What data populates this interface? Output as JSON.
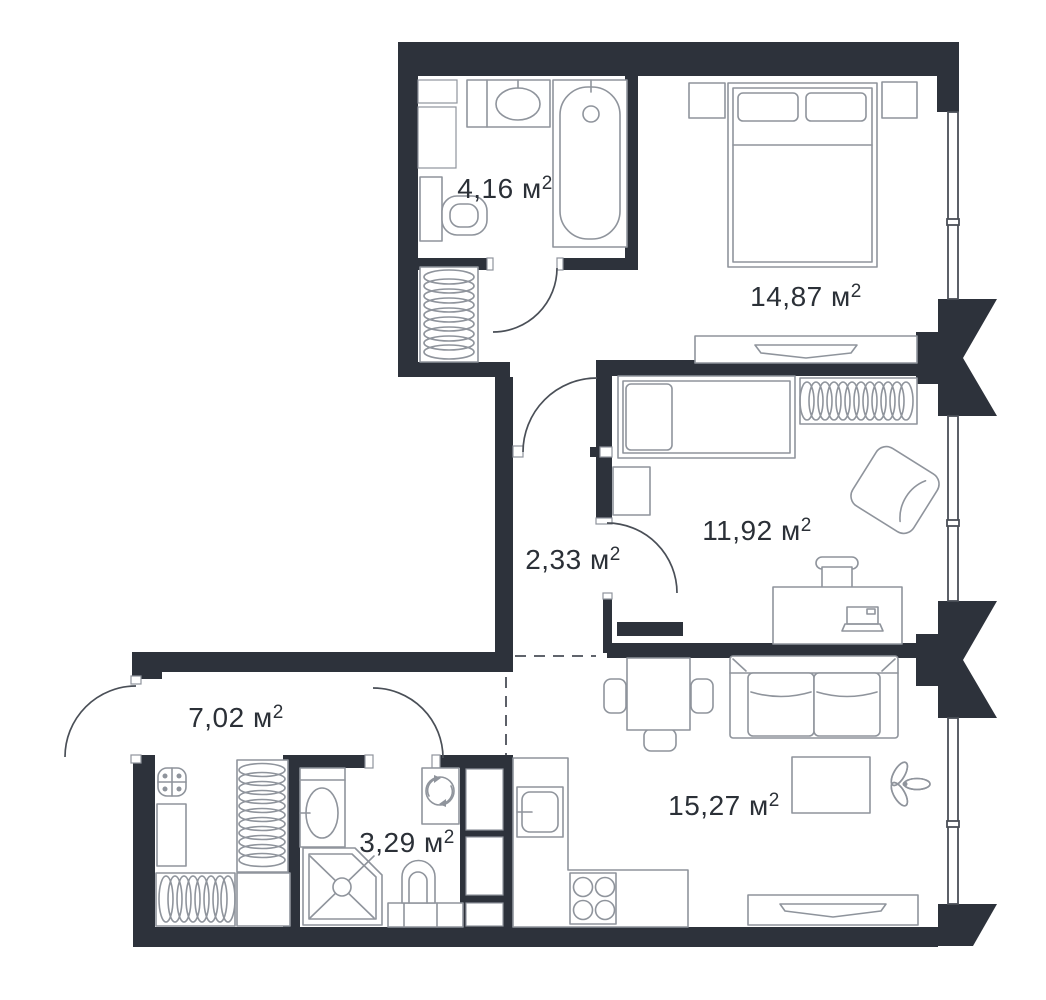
{
  "plan": {
    "type": "apartment-floor-plan",
    "unit_sup": "2",
    "colors": {
      "wall": "#2d323b",
      "line": "#8f949c",
      "door": "#4a4f57",
      "text": "#2b3037",
      "bg": "#ffffff"
    },
    "rooms": [
      {
        "id": "bathroom-top",
        "area_label": "4,16 м"
      },
      {
        "id": "bedroom-main",
        "area_label": "14,87 м"
      },
      {
        "id": "bedroom-second",
        "area_label": "11,92 м"
      },
      {
        "id": "corridor",
        "area_label": "2,33 м"
      },
      {
        "id": "hallway",
        "area_label": "7,02 м"
      },
      {
        "id": "bathroom-bottom",
        "area_label": "3,29 м"
      },
      {
        "id": "living-kitchen",
        "area_label": "15,27 м"
      }
    ],
    "fixtures": [
      "bathtub",
      "sink",
      "toilet",
      "coat-closet",
      "double-bed",
      "nightstand",
      "dresser",
      "single-bed",
      "wardrobe",
      "armchair",
      "desk",
      "desk-chair",
      "laptop",
      "entry-stool",
      "bench",
      "shoe-closet",
      "shower",
      "washing-machine",
      "dining-table",
      "chair",
      "sofa",
      "coffee-table",
      "plant",
      "tv-stand",
      "kitchen-counter",
      "kitchen-sink",
      "stove",
      "window",
      "door",
      "duct-shaft"
    ]
  }
}
